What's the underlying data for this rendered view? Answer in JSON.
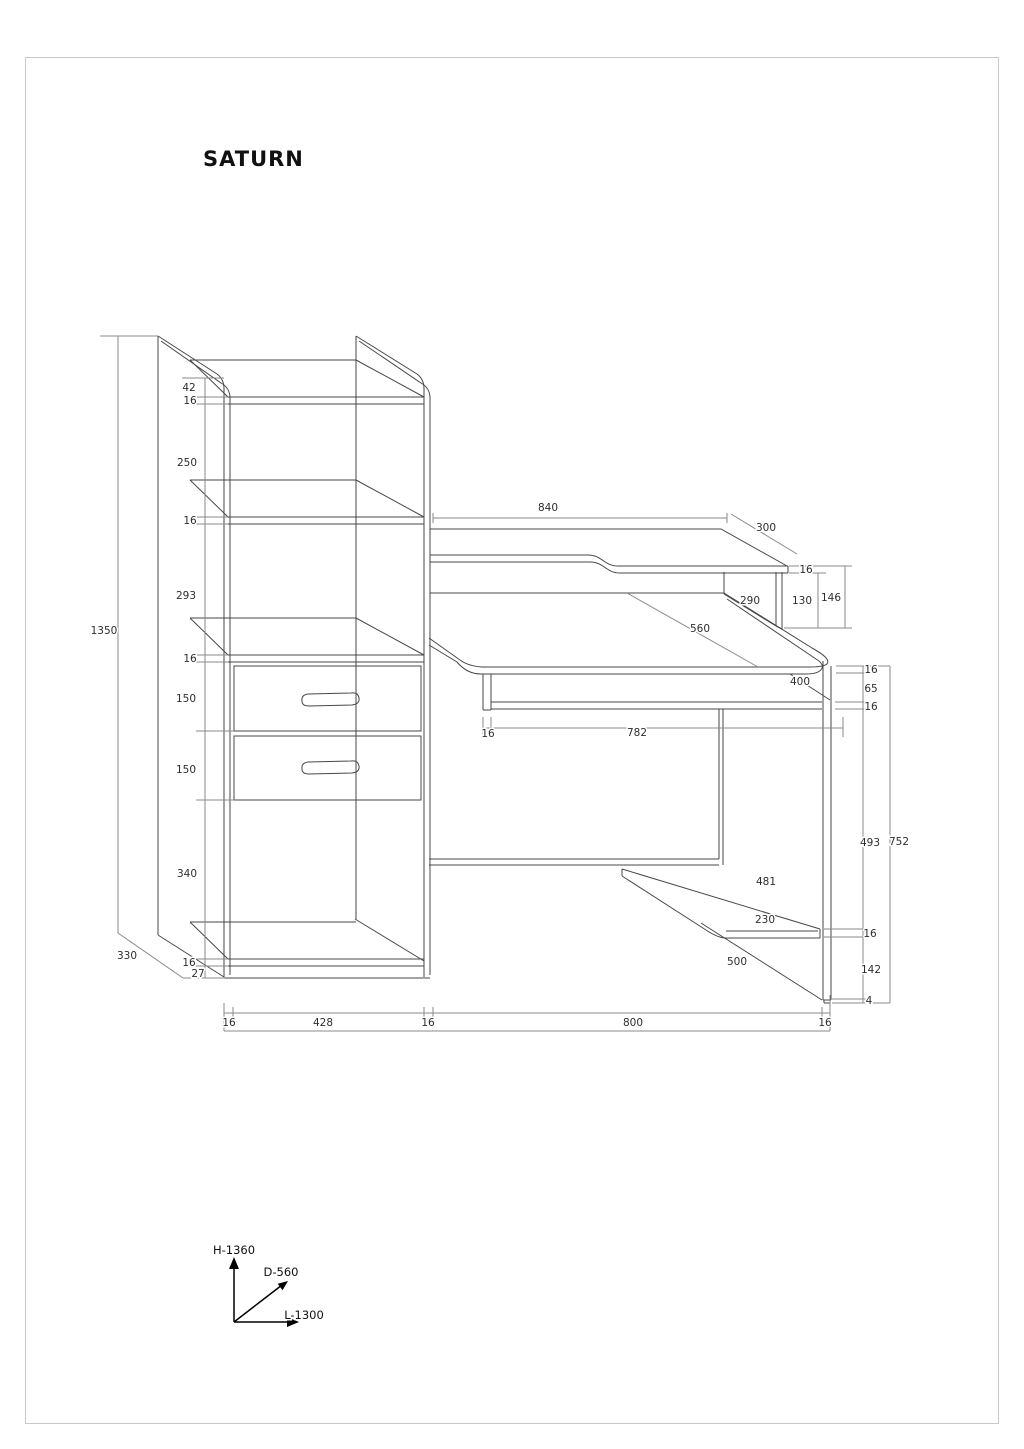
{
  "page": {
    "title": "SATURN"
  },
  "axis_legend": {
    "height": "H-1360",
    "depth": "D-560",
    "length": "L-1300"
  },
  "dims": {
    "cabinet_height": "1350",
    "cabinet_depth": "330",
    "top_offset": "42",
    "top_shelf_thickness": "16",
    "shelf_gap_upper": "250",
    "shelf_thickness_2": "16",
    "shelf_gap_middle": "293",
    "shelf_thickness_3": "16",
    "drawer_height_1": "150",
    "drawer_height_2": "150",
    "open_section_height": "340",
    "bottom_shelf_thickness": "16",
    "plinth_height": "27",
    "base_side_thickness_left": "16",
    "cabinet_inner_width": "428",
    "base_side_thickness_mid": "16",
    "desk_length": "800",
    "base_side_thickness_right": "16",
    "top_shelf_length": "840",
    "top_shelf_depth": "300",
    "top_shelf_board_thickness": "16",
    "riser_height": "130",
    "riser_total_height": "146",
    "riser_depth": "290",
    "desktop_depth": "560",
    "tray_depth": "400",
    "tray_side_thickness": "16",
    "tray_length": "782",
    "desktop_thickness": "16",
    "tray_clearance": "65",
    "tray_thickness": "16",
    "leg_clearance_height": "493",
    "desk_height": "752",
    "cpu_shelf_length": "481",
    "cpu_shelf_depth": "230",
    "cpu_shelf_thickness": "16",
    "leg_depth": "500",
    "cpu_shelf_floor_gap": "142",
    "glide_height": "4"
  }
}
